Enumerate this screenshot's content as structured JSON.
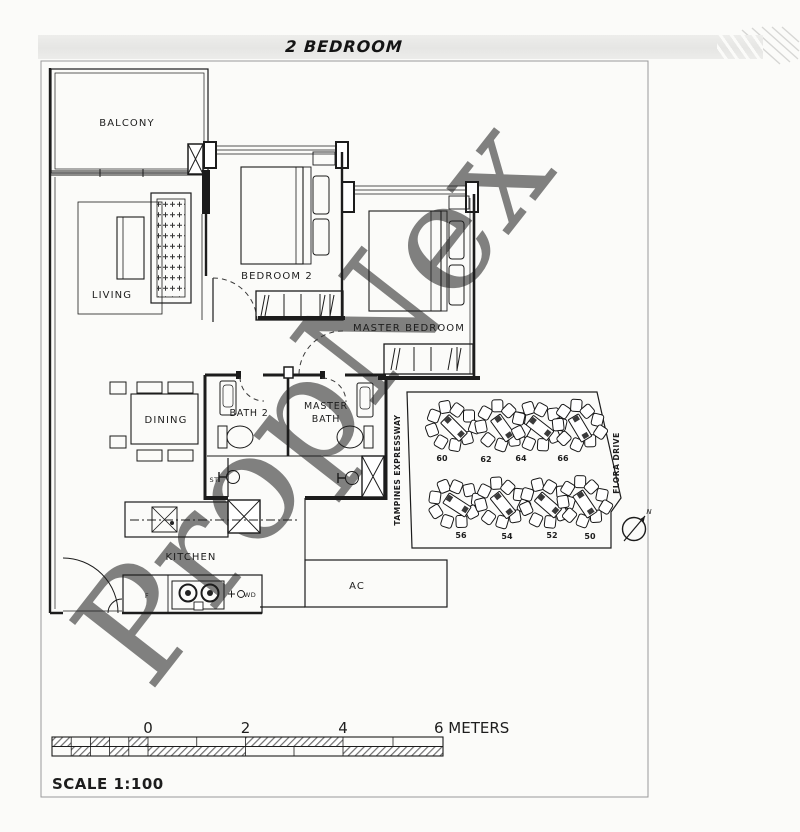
{
  "header": {
    "unit_type": "2 BEDROOM"
  },
  "watermark": {
    "text": "PropNex"
  },
  "floorplan": {
    "labels": {
      "balcony": "BALCONY",
      "living": "LIVING",
      "bedroom2": "BEDROOM 2",
      "master_bedroom": "MASTER BEDROOM",
      "dining": "DINING",
      "bath2": "BATH 2",
      "master_bath_1": "MASTER",
      "master_bath_2": "BATH",
      "store": "ST",
      "kitchen": "KITCHEN",
      "ac_ledge": "AC",
      "fridge": "F",
      "washer_dryer": "WD"
    }
  },
  "siteplan": {
    "road_left": "TAMPINES EXPRESSWAY",
    "road_right": "FLORA DRIVE",
    "north": "N",
    "blocks": [
      "60",
      "62",
      "64",
      "66",
      "56",
      "54",
      "52",
      "50"
    ]
  },
  "scalebar": {
    "tick0": "0",
    "tick2": "2",
    "tick4": "4",
    "tick6": "6 METERS",
    "scale": "SCALE 1:100"
  },
  "colors": {
    "band": "#e9e9e7",
    "ink": "#1c1c1c",
    "watermark": "#c6c6c6",
    "hatch": "#6f6f6f"
  }
}
